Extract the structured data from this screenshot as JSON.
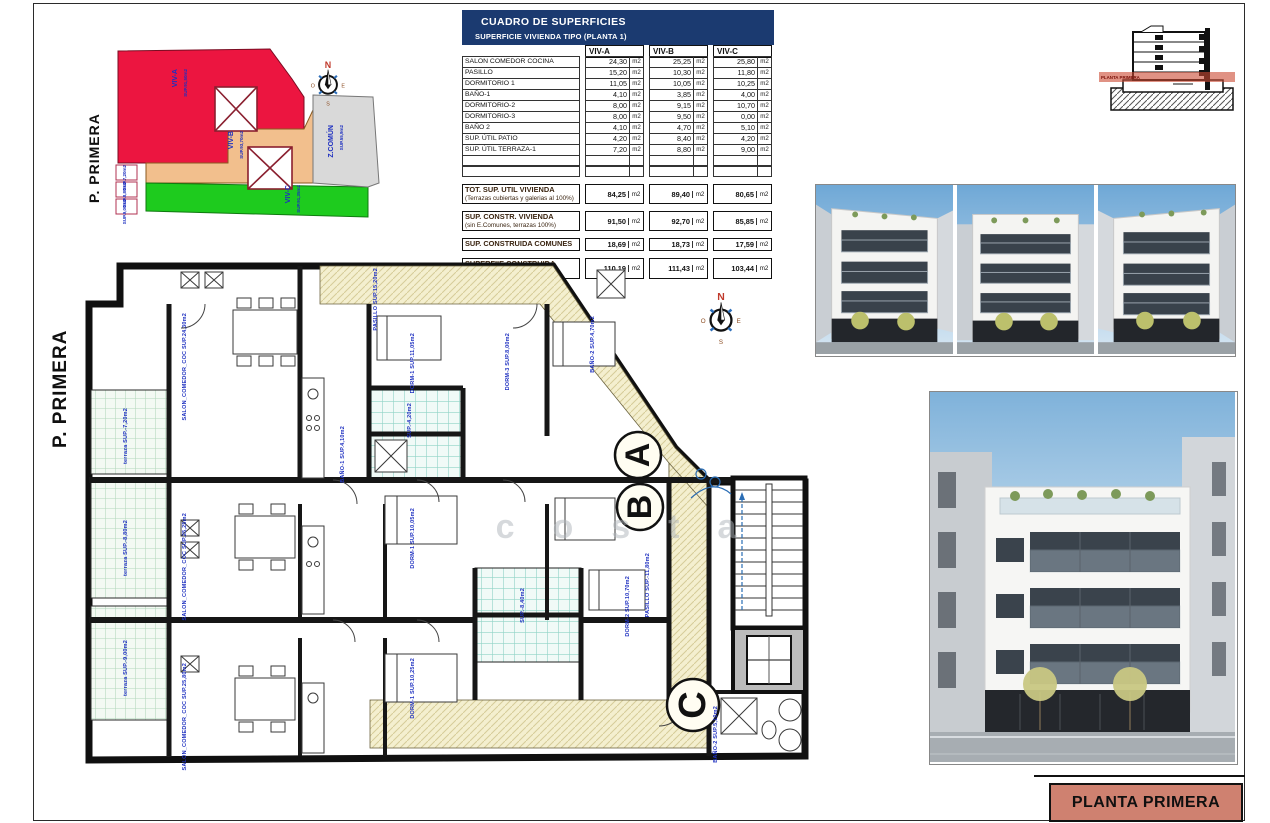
{
  "sheet": {
    "title_block_label": "PLANTA PRIMERA"
  },
  "compass": {
    "n": "N",
    "e": "E",
    "s": "S",
    "o": "O"
  },
  "site_plan": {
    "plan_label": "P. PRIMERA",
    "zones": [
      {
        "name": "VIV-A",
        "sup": "SUP.91,50m2"
      },
      {
        "name": "VIV-B",
        "sup": "SUP.93,70m2"
      },
      {
        "name": "VIV-C",
        "sup": "SUP.91,35m2"
      },
      {
        "name": "Z.COMÚN",
        "sup": "SUP.55,9m2"
      }
    ],
    "strip_labels": [
      "SUP.7,20m2",
      "SUP.8,80m2",
      "SUP.9,00m2"
    ]
  },
  "surfaces_table": {
    "title": "CUADRO DE SUPERFICIES",
    "subtitle": "SUPERFICIE VIVIENDA TIPO  (PLANTA 1)",
    "columns": [
      "VIV-A",
      "VIV-B",
      "VIV-C"
    ],
    "unit": "m2",
    "rows": [
      {
        "label": "SALON COMEDOR COCINA",
        "a": "24,30",
        "b": "25,25",
        "c": "25,80"
      },
      {
        "label": "PASILLO",
        "a": "15,20",
        "b": "10,30",
        "c": "11,80"
      },
      {
        "label": "DORMITORIO 1",
        "a": "11,05",
        "b": "10,05",
        "c": "10,25"
      },
      {
        "label": "BAÑO-1",
        "a": "4,10",
        "b": "3,85",
        "c": "4,00"
      },
      {
        "label": "DORMITORIO-2",
        "a": "8,00",
        "b": "9,15",
        "c": "10,70"
      },
      {
        "label": "DORMITORIO-3",
        "a": "8,00",
        "b": "9,50",
        "c": "0,00"
      },
      {
        "label": "BAÑO 2",
        "a": "4,10",
        "b": "4,70",
        "c": "5,10"
      },
      {
        "label": "SUP. ÚTIL PATIO",
        "a": "4,20",
        "b": "8,40",
        "c": "4,20"
      },
      {
        "label": "SUP. ÚTIL TERRAZA-1",
        "a": "7,20",
        "b": "8,80",
        "c": "9,00"
      }
    ],
    "totals": [
      {
        "label": "TOT. SUP. UTIL VIVIENDA",
        "sub": "(Terrazas cubiertas y galerias al 100%)",
        "a": "84,25",
        "b": "89,40",
        "c": "80,65"
      },
      {
        "label": "SUP. CONSTR. VIVIENDA",
        "sub": "(sin E.Comunes, terrazas 100%)",
        "a": "91,50",
        "b": "92,70",
        "c": "85,85"
      },
      {
        "label": "SUP. CONSTRUIDA COMUNES",
        "sub": "",
        "a": "18,69",
        "b": "18,73",
        "c": "17,59"
      },
      {
        "label": "SUPERFIIE CONSTRUIDA TOTAL",
        "sub": "",
        "a": "110,19",
        "b": "111,43",
        "c": "103,44"
      }
    ]
  },
  "floor_plan": {
    "plan_label": "P. PRIMERA",
    "units": [
      "A",
      "B",
      "C"
    ],
    "watermark": "costa",
    "labels": [
      "SALON_COMEDOR_COC SUP.24,30m2",
      "PASILLO SUP.15,20m2",
      "DORM-1 SUP.11,05m2",
      "DORM-3 SUP.8,00m2",
      "BAÑO-2 SUP.4,70m2",
      "SUP.-4,20m2",
      "BAÑO-1 SUP.4,10m2",
      "SALON_COMEDOR_COC SUP.25,25m2",
      "DORM-1 SUP.10,05m2",
      "SUP.-8,40m2",
      "DORM-2 SUP.10,70m2",
      "SALON_COMEDOR_COC SUP.25,80m2",
      "DORM-1 SUP.10,25m2",
      "BAÑO-2 SUP.5,10m2",
      "terraza SUP.-7,20m2",
      "terraza SUP.-8,80m2",
      "terraza SUP.-9,00m2",
      "PASILLO SUP.-11,80m2"
    ]
  },
  "section": {
    "band_label": "PLANTA PRIMERA"
  }
}
